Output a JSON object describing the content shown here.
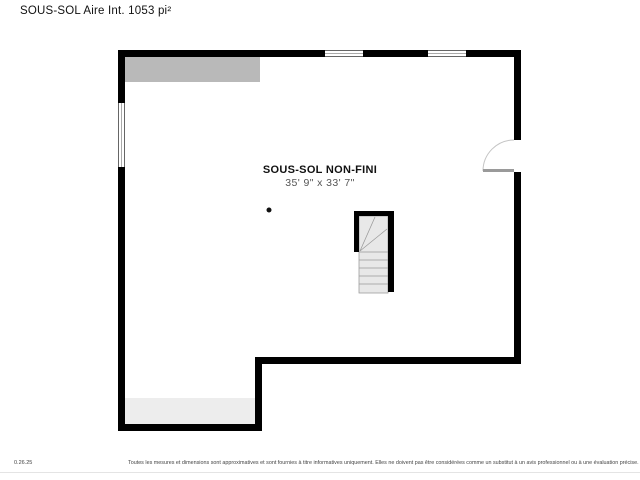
{
  "header": {
    "title": "SOUS-SOL Aire Int. 1053 pi²"
  },
  "floor_plan": {
    "room_label": "SOUS-SOL NON-FINI",
    "room_dimensions": "35' 9\" x 33' 7\"",
    "features": {
      "windows": [
        "top-wall-window-left",
        "top-wall-window-right",
        "left-wall-window"
      ],
      "door": "right-wall-door-swing-in",
      "stairs": "winder-staircase-center",
      "camera_point": "black-dot-marker",
      "shaded_areas": [
        "top-left-gray-area",
        "bottom-left-light-gray-area"
      ]
    },
    "colors": {
      "wall": "#000000",
      "floor": "#ffffff",
      "unfinished_area": "#b9b9b9",
      "slab_area": "#ededed",
      "stair_fill": "#e8e8e8",
      "stair_line": "#999999",
      "door_leaf": "#9a9a9a",
      "door_arc": "#c4c4c4",
      "window_frame": "#666666",
      "dot": "#111111"
    }
  },
  "footer": {
    "version": "0.26.25",
    "disclaimer": "Toutes les mesures et dimensions sont approximatives et sont fournies à titre informatives uniquement. Elles ne doivent pas être considérées comme un substitut à un avis professionnel ou à une évaluation précise."
  }
}
